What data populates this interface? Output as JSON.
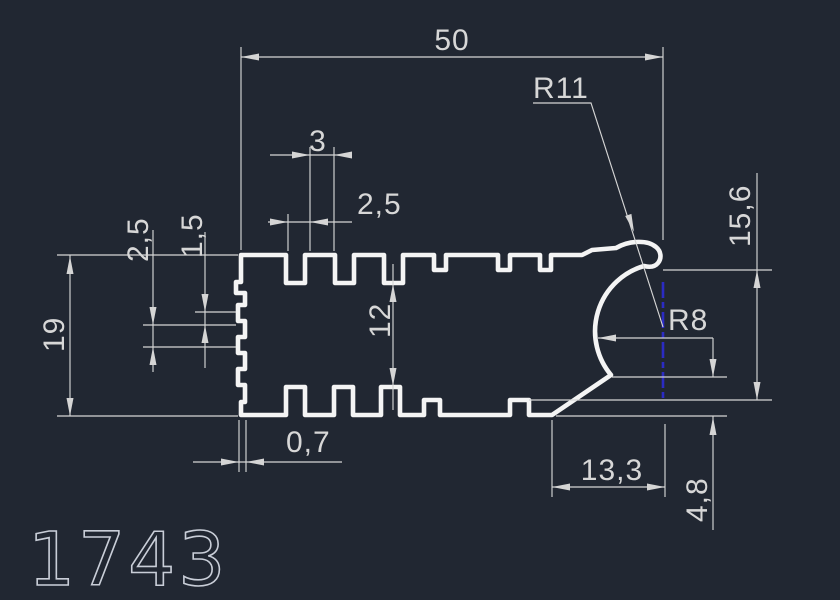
{
  "drawing": {
    "part_number": "1743",
    "background_color": "#212732",
    "profile_line_color": "#f4f4f4",
    "dimension_line_color": "#d5d5d5",
    "centerline_color": "#2b2bc4",
    "dimensions": {
      "overall_width": "50",
      "top_corner_radius": "R11",
      "top_slot_width": "3",
      "top_slot_pitch": "2,5",
      "left_tooth_height": "2,5",
      "left_tooth_gap": "1,5",
      "overall_height": "19",
      "inner_height": "12",
      "right_side_height": "15,6",
      "bulb_radius": "R8",
      "left_tooth_depth": "0,7",
      "bottom_right_offset": "13,3",
      "bulb_bottom_drop": "4,8"
    }
  }
}
